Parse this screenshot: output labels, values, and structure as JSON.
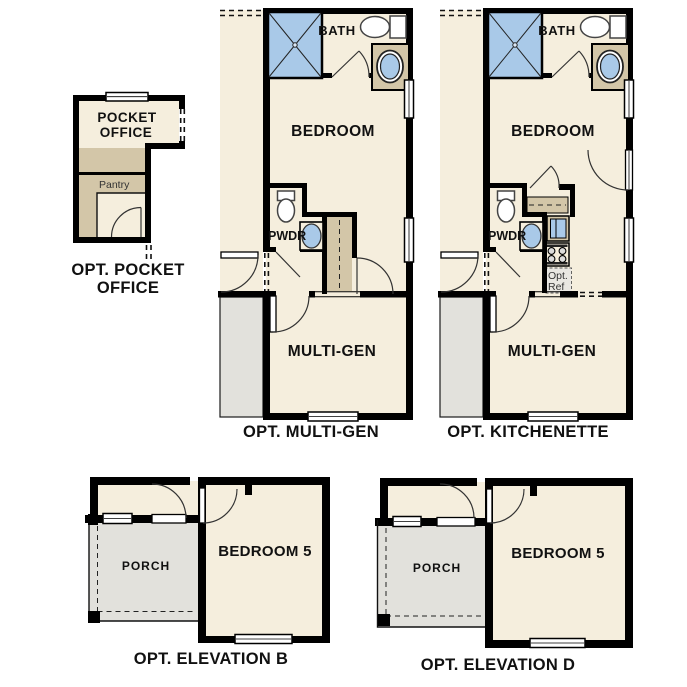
{
  "palette": {
    "floor_cream": "#f5eedd",
    "cabinet_tan": "#d3c6a8",
    "porch_gray": "#e2e1dc",
    "fixture_blue": "#a9c9e8",
    "wall_black": "#000000",
    "text_dark": "#111111"
  },
  "plans": {
    "pocket_office": {
      "room_line1": "POCKET",
      "room_line2": "OFFICE",
      "pantry": "Pantry",
      "caption_line1": "OPT. POCKET",
      "caption_line2": "OFFICE"
    },
    "multi_gen": {
      "bath": "BATH",
      "bedroom": "BEDROOM",
      "powder": "PWDR",
      "room": "MULTI-GEN",
      "caption": "OPT. MULTI-GEN"
    },
    "kitchenette": {
      "bath": "BATH",
      "bedroom": "BEDROOM",
      "powder": "PWDR",
      "room": "MULTI-GEN",
      "ref_line1": "Opt.",
      "ref_line2": "Ref",
      "caption": "OPT. KITCHENETTE"
    },
    "elevation_b": {
      "porch": "PORCH",
      "bedroom": "BEDROOM 5",
      "caption": "OPT. ELEVATION B"
    },
    "elevation_d": {
      "porch": "PORCH",
      "bedroom": "BEDROOM 5",
      "caption": "OPT. ELEVATION D"
    }
  }
}
